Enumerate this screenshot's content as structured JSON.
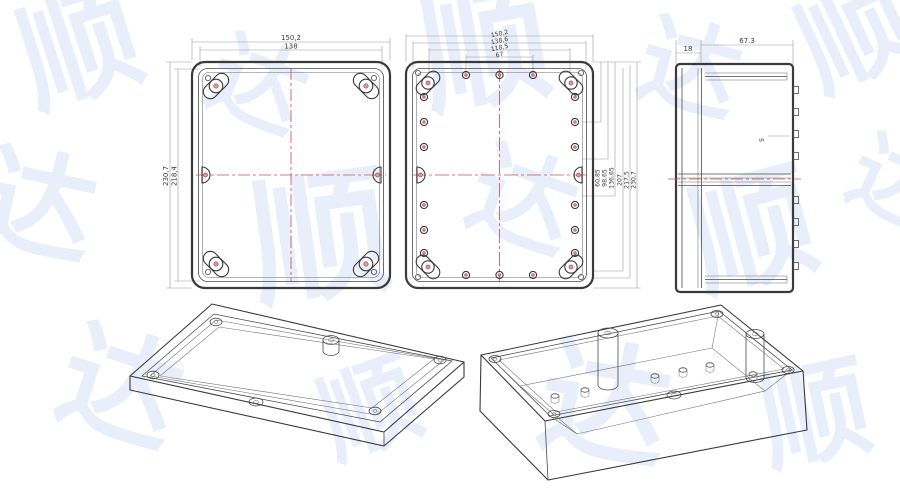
{
  "meta": {
    "description": "Technical drawing of a waterproof plastic enclosure: lid top view, base top view, side view and two isometric 3D views"
  },
  "colors": {
    "background": "#ffffff",
    "outline": "#3a3a3a",
    "dimension_line": "#9a9a9a",
    "centerline": "#cc5555",
    "screw_accent": "#b04848",
    "watermark": "#e9eefb"
  },
  "watermark": {
    "glyphs": [
      "顺",
      "达",
      "顺",
      "达",
      "顺",
      "达",
      "顺",
      "达",
      "顺",
      "达",
      "顺",
      "达",
      "顺",
      "达"
    ]
  },
  "views": {
    "lid_top": {
      "dim_width_outer": "150,2",
      "dim_width_inner": "138",
      "dim_height_outer": "230,7",
      "dim_height_inner": "218,4"
    },
    "base_top": {
      "dims_top": [
        "150,2",
        "138,6",
        "118,5",
        "67"
      ],
      "dims_right": [
        "60,85",
        "98,65",
        "136,65",
        "207",
        "217,5",
        "230,7"
      ]
    },
    "side": {
      "dim_lid_height": "18",
      "dim_base_height": "67.3",
      "tab_label": "5"
    }
  }
}
